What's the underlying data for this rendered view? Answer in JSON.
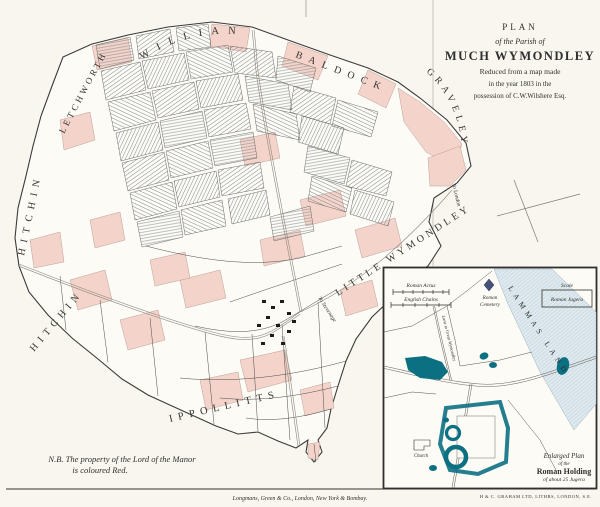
{
  "sheet": {
    "background": "#f8f6ef",
    "ink": "#2f2f2d",
    "manor_pink": "#f4d4ca",
    "roman_teal": "#0c7083",
    "lammas_wash": "#e0eaef"
  },
  "title_block": {
    "plan": "PLAN",
    "parish": "of the Parish of",
    "name": "MUCH WYMONDLEY",
    "line4": "Reduced from a map made",
    "line5": "in the year 1803 in the",
    "line6": "possession of C.W.Wilshere Esq."
  },
  "map_labels": {
    "willian": "WILLIAN",
    "letchworth": "LETCHWORTH",
    "baldock": "BALDOCK",
    "graveley": "GRAVELEY",
    "hitchin_upper": "HITCHIN",
    "hitchin_lower": "HITCHIN",
    "little_wymondley": "LITTLE WYMONDLEY",
    "ippollitts": "IPPOLLITTS",
    "to_london": "To London",
    "to_stevenage": "To Stevenage"
  },
  "note": {
    "line1": "N.B. The property of the Lord of the Manor",
    "line2": "is coloured Red."
  },
  "inset": {
    "bar1_label": "Roman Actus",
    "bar2_label": "English Chains",
    "scale_title": "Scale",
    "scale_unit": "Roman Jugera",
    "lammas_land": "LAMMAS LAND",
    "cemetery_line1": "Roman",
    "cemetery_line2": "Cemetery",
    "lane_label": "Lane to Great Wymondley",
    "church_label": "Church",
    "caption1": "Enlarged Plan",
    "caption2": "of the",
    "caption3": "Roman Holding",
    "caption4": "of about 25 Jugera"
  },
  "credits": {
    "publisher": "Longmans, Green & Co., London, New York & Bombay.",
    "lithographer": "H & C. GRAHAM LTD, LITHRS, LONDON, S.E."
  }
}
